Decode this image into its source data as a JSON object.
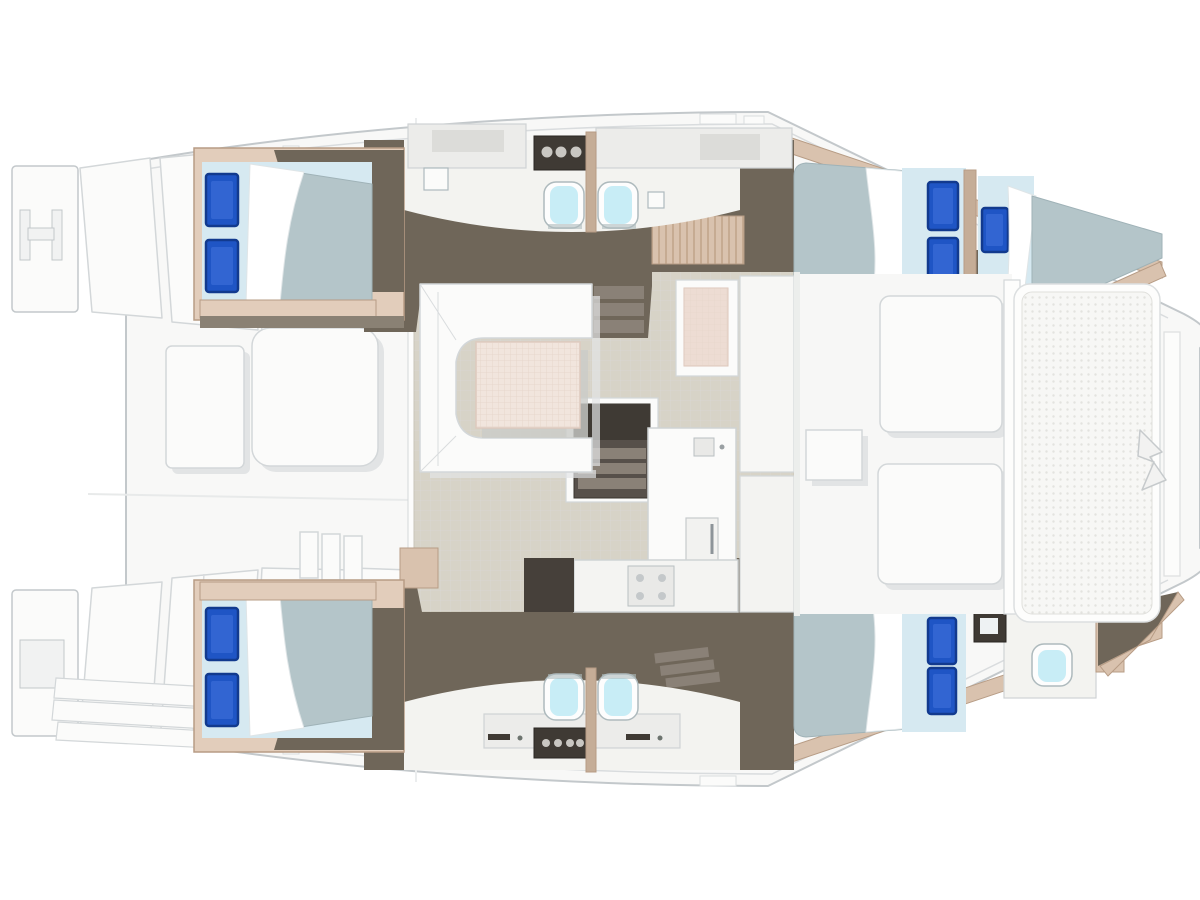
{
  "figure": {
    "type": "yacht-floorplan",
    "description": "Top-down interior layout plan of a four-cabin sailing catamaran, bow to the right",
    "orientation": {
      "bow": "right",
      "stern": "left"
    },
    "features": [
      "stern-swim-platforms",
      "aft-deck-steps-and-seating",
      "salon-u-sofa-and-table",
      "galley-counters-with-sink-stove-fridge",
      "companionway-stairs",
      "port-hull-aft-double-cabin",
      "port-hull-twin-heads-with-toilets",
      "port-hull-forward-double-cabin",
      "port-bow-berth",
      "starboard-hull-aft-double-cabin",
      "starboard-hull-twin-heads-with-toilets",
      "starboard-hull-forward-double-cabin",
      "starboard-bow-head-compartment",
      "forward-cockpit-bench-seats",
      "bow-trampoline-net",
      "forestay-bridle-fitting"
    ]
  },
  "colors": {
    "deck": "#f8f8f7",
    "outline": "#c3c8cb",
    "innerline": "#d9dcde",
    "white": "#fbfbfa",
    "soft": "#d3d7d9",
    "shadow": "#e2e4e5",
    "dark": "#6f6659",
    "darker": "#57504a",
    "darkest": "#3f3a34",
    "tread": "#8a8177",
    "tan": "#d9c2ae",
    "tanLight": "#e2cdbb",
    "tanStroke": "#b79c85",
    "tanWall": "#c5ad97",
    "mattress": "#b4c5c9",
    "mattressStroke": "#9fb2b7",
    "bedding": "#d6e9f1",
    "sheet": "#ffffff",
    "pillow": "#1f55c5",
    "pillowStroke": "#123a8e",
    "pillowHi": "#3a6bd6",
    "toilet": "#c8edf6",
    "toiletBody": "#fdfdfd",
    "toiletStroke": "#aebabd",
    "floorSalon": "#d7d3c7",
    "floorGrid": "#ccc7ba",
    "bath": "#f3f3f0",
    "counter": "#ececea",
    "counterStroke": "#cfd3d4",
    "table": "#f1e5dd",
    "tableStroke": "#ddc9bd",
    "cushion": "#eddcd3",
    "tramp": "#f7f7f5",
    "trampDot": "#e3e3df"
  }
}
